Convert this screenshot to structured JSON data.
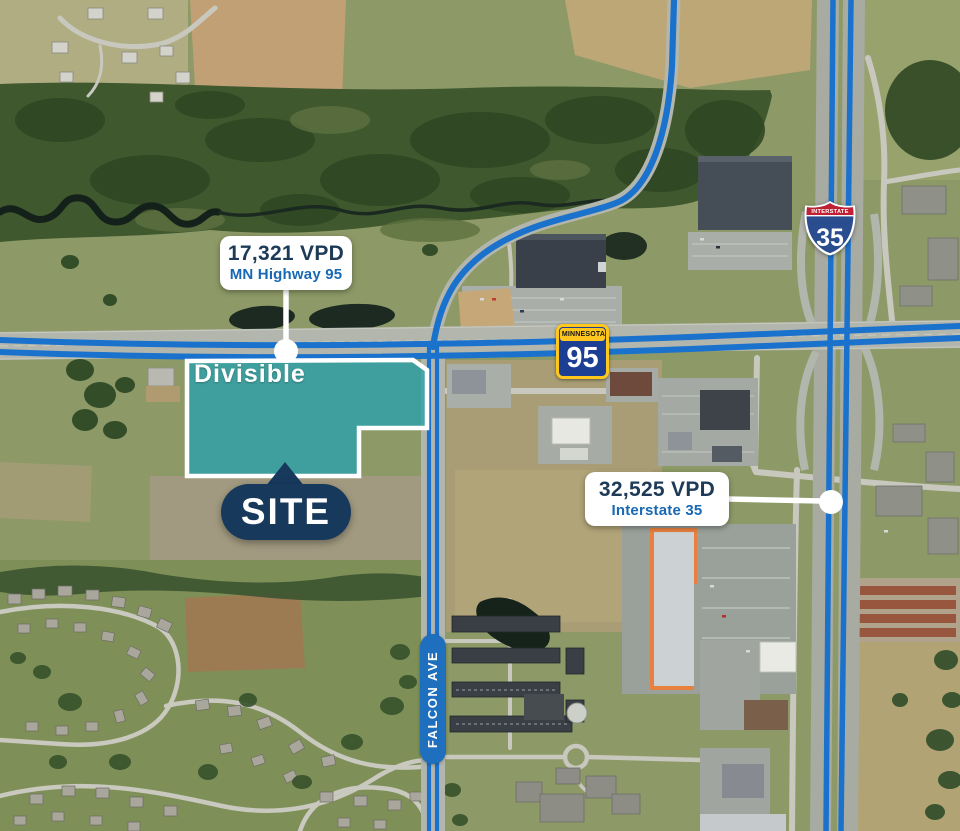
{
  "site": {
    "badge_label": "SITE",
    "divisible_label": "Divisible"
  },
  "callouts": [
    {
      "value": "17,321 VPD",
      "road": "MN Highway 95"
    },
    {
      "value": "32,525 VPD",
      "road": "Interstate 35"
    }
  ],
  "shields": {
    "interstate": {
      "banner": "INTERSTATE",
      "number": "35"
    },
    "minnesota": {
      "banner": "MINNESOTA",
      "number": "95"
    }
  },
  "road_labels": {
    "falcon": "FALCON AVE"
  },
  "colors": {
    "navy": "#17395c",
    "callout_value_navy": "#1d3a57",
    "callout_road_blue": "#1769b5",
    "route_overlay_blue": "#1a72cc",
    "site_fill_teal": "#2ca0ac",
    "site_border_white": "#ffffff",
    "falcon_pill_blue": "#1e6fbd",
    "interstate_red": "#bf2033",
    "interstate_blue": "#2a4d8f",
    "mn_yellow": "#ffc71e",
    "mn_blue": "#1c3f94"
  }
}
